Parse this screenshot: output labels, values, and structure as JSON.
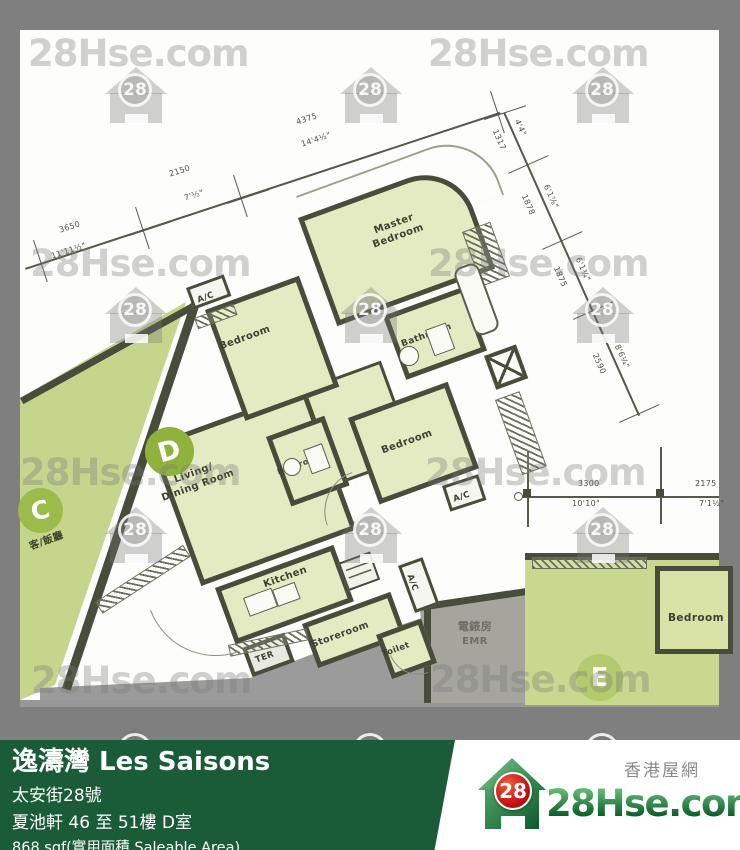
{
  "watermark": {
    "text": "28Hse.com",
    "badge": "28"
  },
  "plan": {
    "units": {
      "c": {
        "badge": "C",
        "room_label": "客/飯廳"
      },
      "d": {
        "badge": "D"
      },
      "e": {
        "badge": "E",
        "bedroom": "Bedroom"
      }
    },
    "rooms": {
      "master_line1": "Master",
      "master_line2": "Bedroom",
      "bedroom": "Bedroom",
      "bathroom": "Bathroom",
      "living_line1": "Living/",
      "living_line2": "Dining Room",
      "kitchen": "Kitchen",
      "storeroom": "Storeroom",
      "toilet": "Toilet",
      "terrace": "TER",
      "ac": "A/C",
      "emr_zh": "電錶房",
      "emr_en": "EMR"
    },
    "dimensions": {
      "top": [
        {
          "mm": "3650",
          "ft": "11'11½\""
        },
        {
          "mm": "2150",
          "ft": "7'½\""
        },
        {
          "mm": "4375",
          "ft": "14'4½\""
        }
      ],
      "right": [
        {
          "mm": "1317",
          "ft": "4'4\""
        },
        {
          "mm": "1878",
          "ft": "6'1⅞\""
        },
        {
          "mm": "1875",
          "ft": "6'1¾\""
        },
        {
          "mm": "2590",
          "ft": "8'6¼\""
        }
      ],
      "bottom": [
        {
          "mm": "3300",
          "ft": "10'10\""
        },
        {
          "mm": "2175",
          "ft": "7'1½\""
        }
      ]
    }
  },
  "banner": {
    "estate_name": "逸濤灣 Les Saisons",
    "address": "太安街28號",
    "block_floor_unit": "夏池軒 46 至 51樓 D室",
    "area": "868 sqf(實用面積 Saleable Area)"
  },
  "logo": {
    "site_name_zh": "香港屋網",
    "site_name": "28Hse.com",
    "badge": "28"
  },
  "colors": {
    "frame_gray": "#7f7f7f",
    "room_fill": "#e4ebc2",
    "adjacent_fill": "#c6d58c",
    "wall": "#474c3b",
    "banner_green": "#1a5c38",
    "logo_red": "#c01010",
    "logo_green": "#1c7a40"
  }
}
